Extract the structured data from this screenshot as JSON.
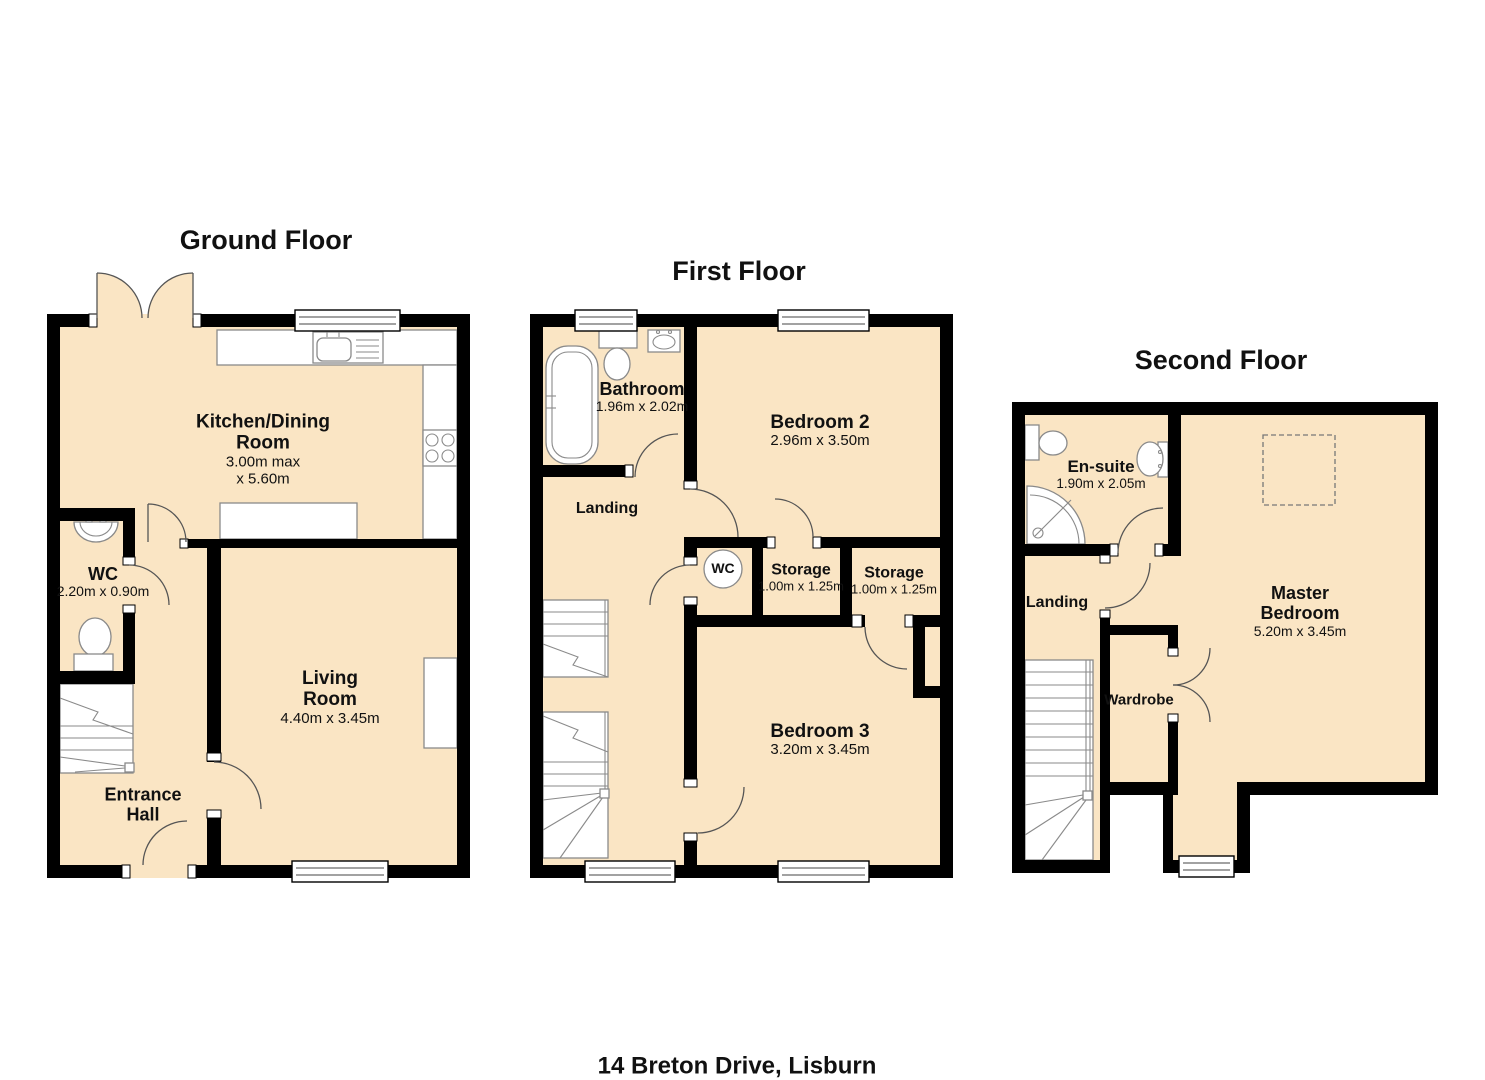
{
  "address": "14 Breton Drive, Lisburn",
  "colors": {
    "floor_fill": "#FAE5C4",
    "wall": "#000000",
    "fixture_stroke": "#8a8a8a",
    "detail_stroke": "#555555",
    "text": "#111111"
  },
  "floors": {
    "ground": {
      "title": "Ground Floor",
      "kitchen": {
        "name1": "Kitchen/Dining",
        "name2": "Room",
        "dim1": "3.00m max",
        "dim2": "x 5.60m"
      },
      "wc": {
        "name": "WC",
        "dims": "2.20m x 0.90m"
      },
      "living": {
        "name1": "Living",
        "name2": "Room",
        "dims": "4.40m x 3.45m"
      },
      "hall": {
        "name1": "Entrance",
        "name2": "Hall"
      }
    },
    "first": {
      "title": "First Floor",
      "bathroom": {
        "name": "Bathroom",
        "dims": "1.96m x 2.02m"
      },
      "bedroom2": {
        "name": "Bedroom 2",
        "dims": "2.96m x 3.50m"
      },
      "landing": {
        "name": "Landing"
      },
      "wc_circle": {
        "name": "WC"
      },
      "storage1": {
        "name": "Storage",
        "dims": "1.00m x 1.25m"
      },
      "storage2": {
        "name": "Storage",
        "dims": "1.00m x 1.25m"
      },
      "bedroom3": {
        "name": "Bedroom 3",
        "dims": "3.20m x 3.45m"
      }
    },
    "second": {
      "title": "Second Floor",
      "ensuite": {
        "name": "En-suite",
        "dims": "1.90m x 2.05m"
      },
      "landing": {
        "name": "Landing"
      },
      "master": {
        "name1": "Master",
        "name2": "Bedroom",
        "dims": "5.20m x 3.45m"
      },
      "wardrobe": {
        "name": "Wardrobe"
      }
    }
  }
}
